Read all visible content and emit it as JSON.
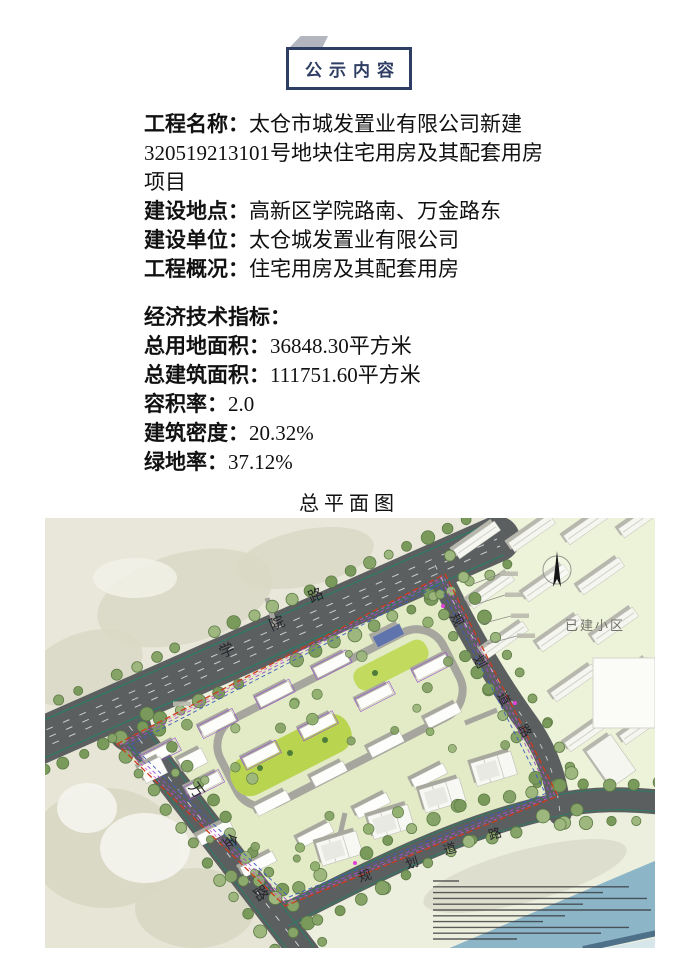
{
  "header": {
    "title": "公示内容"
  },
  "notice": {
    "fields": [
      {
        "label": "工程名称：",
        "value": "太仓市城发置业有限公司新建320519213101号地块住宅用房及其配套用房项目"
      },
      {
        "label": "建设地点：",
        "value": "高新区学院路南、万金路东"
      },
      {
        "label": "建设单位：",
        "value": "太仓城发置业有限公司"
      },
      {
        "label": "工程概况：",
        "value": "住宅用房及其配套用房"
      }
    ],
    "indicators_title": "经济技术指标：",
    "indicators": [
      {
        "label": "总用地面积：",
        "value": "36848.30平方米"
      },
      {
        "label": "总建筑面积：",
        "value": "111751.60平方米"
      },
      {
        "label": "容积率：",
        "value": "2.0"
      },
      {
        "label": "建筑密度：",
        "value": "20.32%"
      },
      {
        "label": "绿地率：",
        "value": "37.12%"
      }
    ]
  },
  "plan": {
    "title": "总平面图"
  },
  "site_plan": {
    "road_labels": {
      "xueyuan": "学院路",
      "wanjin": "万金路",
      "planned_east": "规划道路",
      "planned_south": "规划道路"
    },
    "area_labels": {
      "existing_community": "已建小区"
    },
    "colors": {
      "base": "#ecefdd",
      "ne_zone": "#edf3d9",
      "beige": "#e8e7d9",
      "beige_blob": "#d9d8c5",
      "site": "#e2eac6",
      "road": "#5c5f60",
      "road_teal": "#2f7a64",
      "lane_white": "#cdd0cf",
      "tree_a": "#87a468",
      "tree_b": "#7a9a5c",
      "tree_c": "#9db77e",
      "tree_edge": "#5d7a45",
      "green_axis": "#b9d44f",
      "inner_road": "#a6a69e",
      "building_white": "#fdfdfb",
      "building_shadow": "#a8a89f",
      "existing_shadow": "#b7b7ae",
      "boundary_red": "#ce3a1e",
      "boundary_purple": "#9a4fd0",
      "boundary_blue": "#3e59c4",
      "boundary_magenta": "#d84fd0",
      "river": "#8cb5c8",
      "river_edge": "#4e7089",
      "river_corner": "#d6e6ea",
      "label_dark": "#26262a",
      "label_gray": "#72726a",
      "blue_roof": "#5f74ac"
    }
  }
}
